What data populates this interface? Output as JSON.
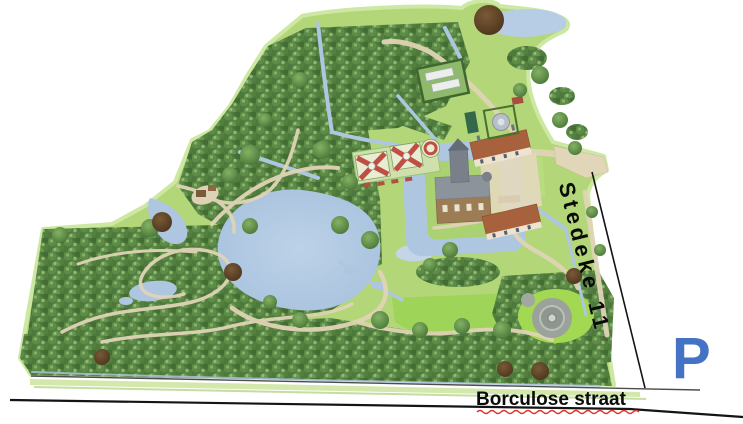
{
  "page": {
    "background": "#ffffff",
    "description": "Illustrated bird's-eye map of a moated castle estate with gardens and woods"
  },
  "labels": {
    "side_street": "Stedeke 11",
    "bottom_street": "Borculose straat",
    "parking": "P"
  },
  "colors": {
    "parking_blue": "#4472C4",
    "road_line_dark": "#141414",
    "road_line_gray": "#4d4d4d",
    "misspell_underline_red": "#e0342b",
    "water": "#b2c9e2",
    "lawn": "#b2d678",
    "forest": "#4d7a3c",
    "path_tan": "#e0d4b6",
    "roof_terracotta": "#a8613d"
  },
  "map_features": [
    "dense-forest-with-winding-paths",
    "large-central-pond",
    "castle-island-with-moat",
    "formal-parterre-gardens",
    "estate-outbuildings-terracotta-roofs",
    "walled-kitchen-garden-greenhouses",
    "round-mount-folly",
    "roadside-parking"
  ]
}
